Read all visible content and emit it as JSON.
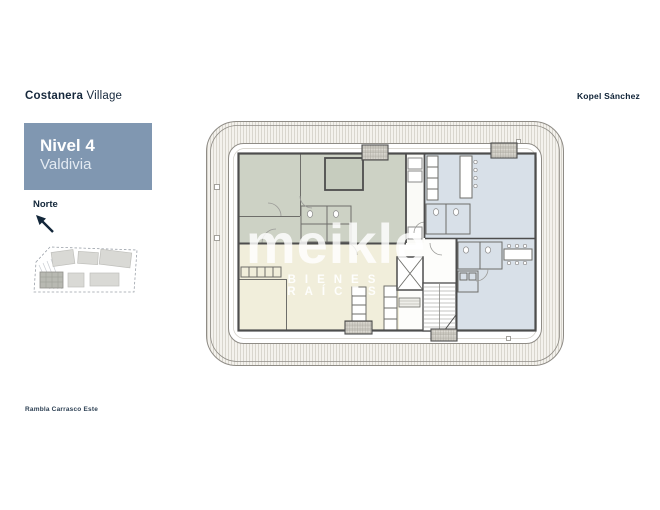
{
  "header": {
    "project_name_bold": "Costanera",
    "project_name_light": " Village",
    "brand": "Kopel Sánchez"
  },
  "level_card": {
    "title": "Nivel 4",
    "subtitle": "Valdivia",
    "background": "#8097b1"
  },
  "compass": {
    "label": "Norte",
    "direction": "up-left"
  },
  "site_plan": {
    "icon": "site-plan-mini-map",
    "highlighted_building": "bottom-left"
  },
  "floor_plan": {
    "type": "architectural-floor-plan",
    "units": [
      {
        "name": "unit-top-left",
        "color": "#cdd2c5"
      },
      {
        "name": "unit-top-right",
        "color": "#d8e0e8"
      },
      {
        "name": "unit-bottom-right",
        "color": "#d8e0e8"
      },
      {
        "name": "unit-bottom-left",
        "color": "#f1eedb"
      }
    ],
    "core": [
      "elevator",
      "stairs"
    ],
    "wall_color": "#4d4d4d",
    "deck_stripe_color": "#d6d3ca"
  },
  "watermark": {
    "word": "meikle",
    "tagline": "BIENES RAÍCES"
  },
  "street_label": "Rambla Carrasco Este",
  "colors": {
    "navy_text": "#16283c",
    "card_blue": "#8097b1"
  }
}
